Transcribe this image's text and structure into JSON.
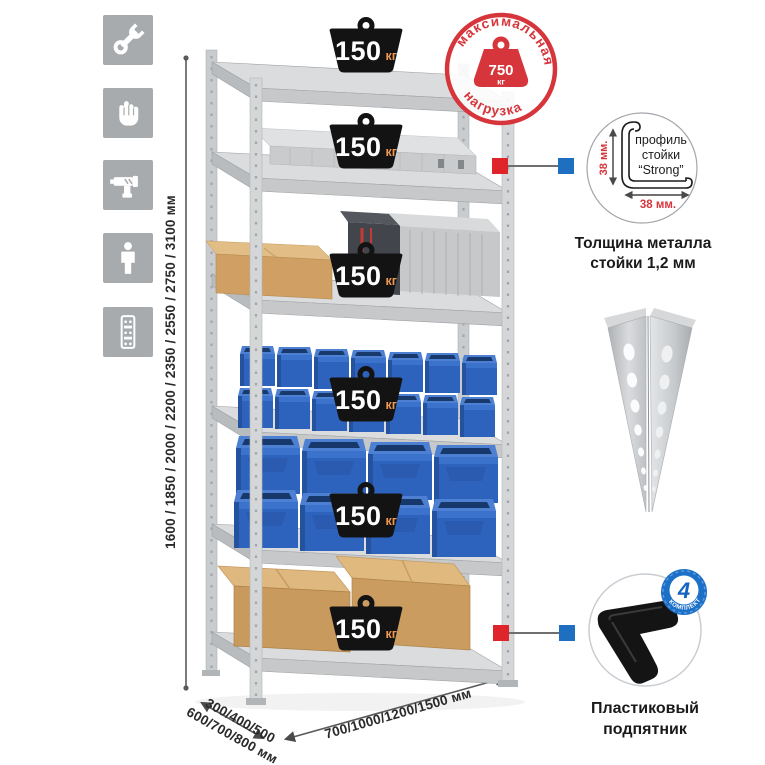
{
  "sidebar": {
    "icons": [
      {
        "name": "wrench"
      },
      {
        "name": "gloves"
      },
      {
        "name": "drill"
      },
      {
        "name": "person"
      },
      {
        "name": "rack-post"
      }
    ]
  },
  "dimensions": {
    "height": "1600 / 1850 / 2000 / 2200 / 2350 / 2550 / 2750 / 3100 мм",
    "depth_line1": "300/400/500",
    "depth_line2": "600/700/800 мм",
    "width": "700/1000/1200/1500 мм"
  },
  "max_load_stamp": {
    "arc_top": "максимальная",
    "arc_bottom": "нагрузка",
    "value": "750",
    "unit": "кг"
  },
  "rack": {
    "shelf_loads": [
      {
        "value": "150",
        "unit": "кг"
      },
      {
        "value": "150",
        "unit": "кг"
      },
      {
        "value": "150",
        "unit": "кг"
      },
      {
        "value": "150",
        "unit": "кг"
      },
      {
        "value": "150",
        "unit": "кг"
      },
      {
        "value": "150",
        "unit": "кг"
      }
    ]
  },
  "profile_detail": {
    "label_line1": "профиль",
    "label_line2": "стойки",
    "label_line3": "“Strong”",
    "height_dim": "38 мм.",
    "width_dim": "38 мм.",
    "caption_line1": "Толщина металла",
    "caption_line2": "стойки 1,2 мм"
  },
  "foot_detail": {
    "badge_count": "4",
    "badge_caption": "в комплекте",
    "caption_line1": "Пластиковый",
    "caption_line2": "подпятник"
  },
  "colors": {
    "stamp_red": "#d6363b",
    "marker_red": "#e0242b",
    "marker_blue": "#1e6fc0",
    "bin_blue": "#2e63bd",
    "kg_orange": "#ef9850",
    "tile_gray": "#a7abae"
  }
}
